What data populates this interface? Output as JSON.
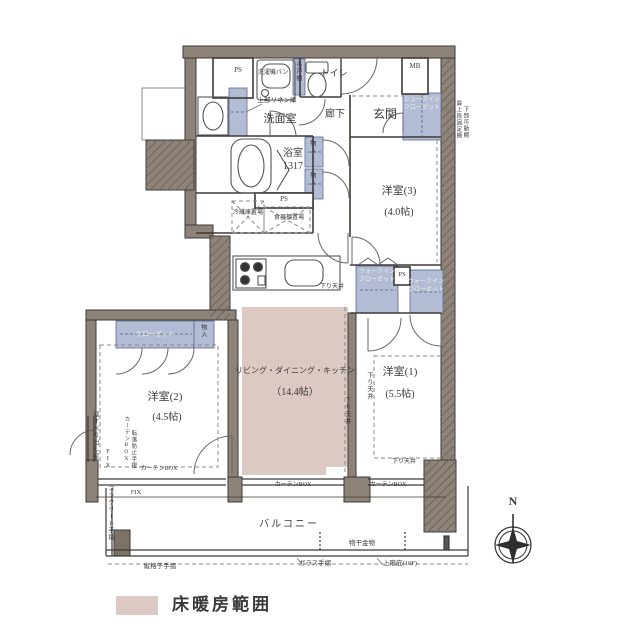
{
  "colors": {
    "wall": "#8e8379",
    "hatch_line": "#6e6559",
    "storage_fill": "#b2bcd4",
    "floor_heating": "#dcc9c3",
    "line": "#3e3a36"
  },
  "rooms": {
    "ldk_name": "リビング・ダイニング・キッチン",
    "ldk_size": "（14.4帖）",
    "bedroom1_name": "洋室(1)",
    "bedroom1_size": "(5.5帖)",
    "bedroom2_name": "洋室(2)",
    "bedroom2_size": "(4.5帖)",
    "bedroom3_name": "洋室(3)",
    "bedroom3_size": "(4.0帖)",
    "bath_name": "浴室",
    "bath_size": "1317",
    "washroom": "洗面室",
    "toilet": "トイレ",
    "hallway": "廊下",
    "entrance": "玄関",
    "balcony": "バルコニー"
  },
  "storage": {
    "sic_line1": "シューズイン",
    "sic_line2": "クローゼット",
    "wic_line1": "ウォークイン",
    "wic_line2": "クローゼット",
    "closet": "クローゼット",
    "mono": "物入",
    "linen_note": "上部リネン庫",
    "hanging": "吊戸棚",
    "washer_pan": "洗濯機パン",
    "fridge": "冷蔵庫置場",
    "cupboard": "食器棚置場"
  },
  "service": {
    "ps": "PS",
    "mb": "MB"
  },
  "notes": {
    "lowered_ceiling": "下り天井",
    "curtain_box": "カーテンBOX",
    "fix": "FIX",
    "casement_window": "縦すべり出し窓",
    "fall_rail": "転落防止手摺",
    "concrete_rail": "コンクリート手摺",
    "lattice_rail": "縦格子手摺",
    "glass_rail": "ガラス手摺",
    "upper_floor": "上階庇(10F)",
    "laundry_fitting": "物干金物",
    "shelf_note1": "最上段固定棚",
    "shelf_note2": "下部可動棚"
  },
  "compass": {
    "north": "N"
  },
  "legend": {
    "floor_heating": "床暖房範囲"
  }
}
